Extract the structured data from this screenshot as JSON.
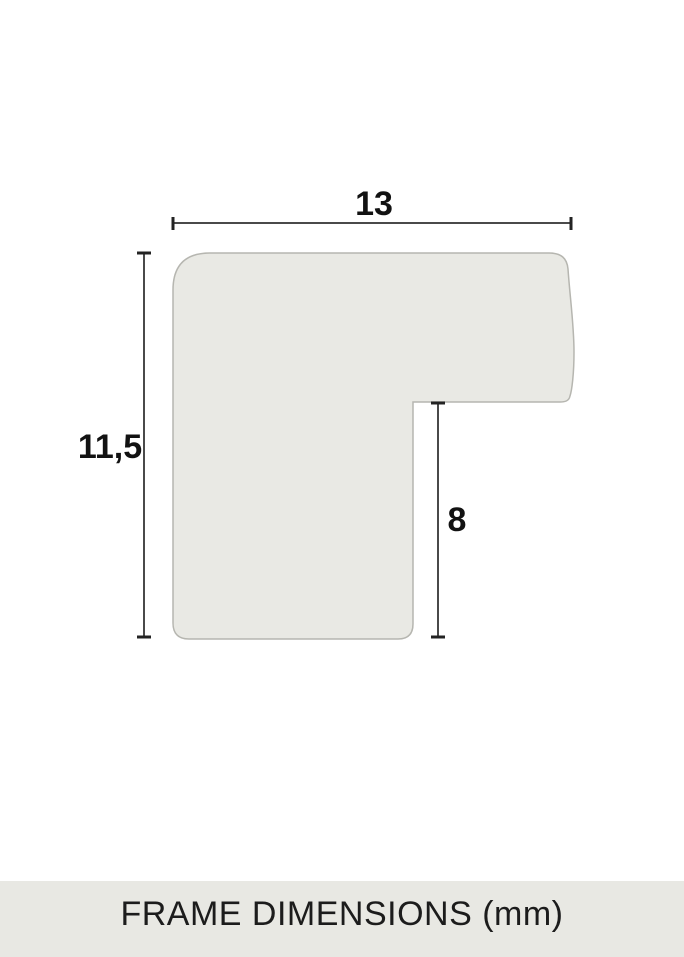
{
  "diagram": {
    "width_label": "13",
    "height_label": "11,5",
    "rabbet_label": "8"
  },
  "colors": {
    "background": "#ffffff",
    "shape_fill": "#e9e9e4",
    "shape_stroke": "#b6b6b0",
    "dimension_line": "#4a4a4a",
    "tick": "#232323",
    "label_text": "#121212",
    "footer_background": "#e8e8e3",
    "footer_text": "#1c1c1c"
  },
  "footer": {
    "title": "FRAME DIMENSIONS (mm)"
  }
}
